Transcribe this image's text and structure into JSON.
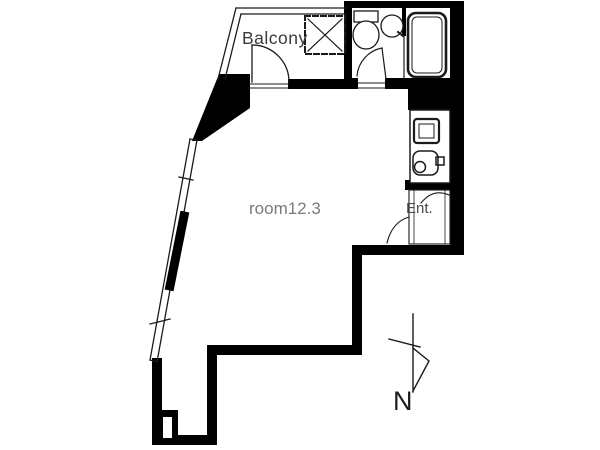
{
  "floorplan": {
    "labels": {
      "balcony": "Balcony",
      "room": "room12.3",
      "entrance": "Ent.",
      "compass_north": "N"
    },
    "colors": {
      "wall": "#000000",
      "line": "#1a1a1a",
      "thin_line": "#333333",
      "background": "#ffffff",
      "room_label": "#7b7b7b",
      "balcony_label": "#3a3a3a",
      "entrance_label": "#4a4a4a",
      "compass_label": "#1c1c1c"
    },
    "icons": [
      "toilet-icon",
      "wash-basin-icon",
      "bathtub-icon",
      "washing-machine-pad-icon",
      "kitchen-sink-icon",
      "stove-icon",
      "north-arrow-icon"
    ]
  }
}
